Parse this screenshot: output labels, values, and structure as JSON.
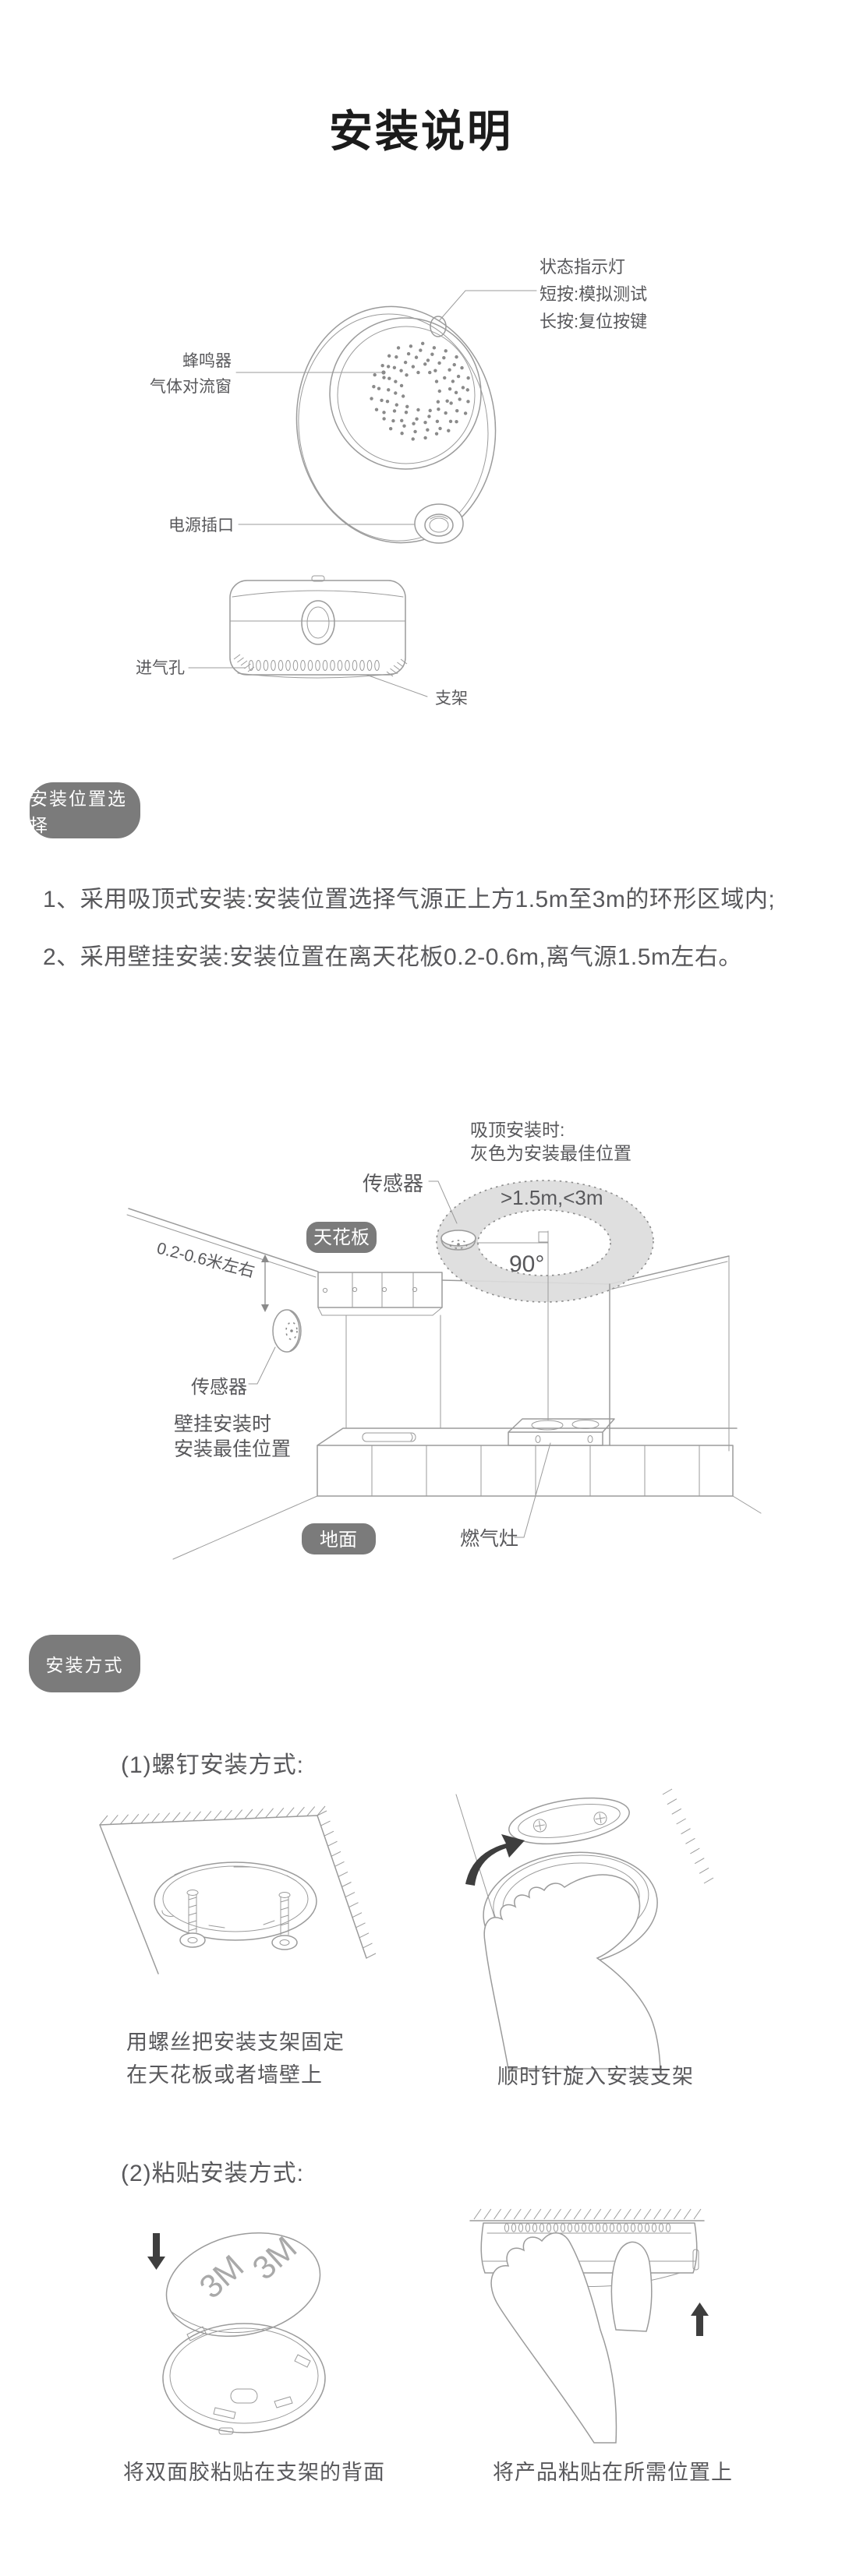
{
  "page": {
    "title": "安装说明"
  },
  "colors": {
    "text": "#58585b",
    "title": "#1b1b1b",
    "line": "#9b9b9b",
    "line-dark": "#8a8a8a",
    "badge-bg": "#7b7b7b",
    "badge-fg": "#ffffff",
    "donut": "#dcdcdc",
    "arrow": "#3e3e3e",
    "gray3m": "#a9a9a9"
  },
  "device": {
    "labels": {
      "status_light": "状态指示灯",
      "short_press": "短按:模拟测试",
      "long_press": "长按:复位按键",
      "buzzer": "蜂鸣器",
      "gas_window": "气体对流窗",
      "power_port": "电源插口",
      "air_inlet": "进气孔",
      "bracket": "支架"
    }
  },
  "position_section": {
    "badge": "安装位置选择",
    "items": [
      "1、采用吸顶式安装:安装位置选择气源正上方1.5m至3m的环形区域内;",
      "2、采用壁挂安装:安装位置在离天花板0.2-0.6m,离气源1.5m左右。"
    ]
  },
  "kitchen": {
    "note1": "吸顶安装时:",
    "note2": "灰色为安装最佳位置",
    "sensor_ceiling": "传感器",
    "range_label": ">1.5m,<3m",
    "ceiling_badge": "天花板",
    "angle": "90°",
    "wall_distance": "0.2-0.6米左右",
    "sensor_wall": "传感器",
    "wall_note1": "壁挂安装时",
    "wall_note2": "安装最佳位置",
    "floor_badge": "地面",
    "stove_label": "燃气灶"
  },
  "methods": {
    "badge": "安装方式",
    "m1_title": "(1)螺钉安装方式:",
    "m1_caption_left_1": "用螺丝把安装支架固定",
    "m1_caption_left_2": "在天花板或者墙壁上",
    "m1_caption_right": "顺时针旋入安装支架",
    "m2_title": "(2)粘贴安装方式:",
    "m2_caption_left": "将双面胶粘贴在支架的背面",
    "m2_caption_right": "将产品粘贴在所需位置上",
    "sticker": "3M"
  }
}
